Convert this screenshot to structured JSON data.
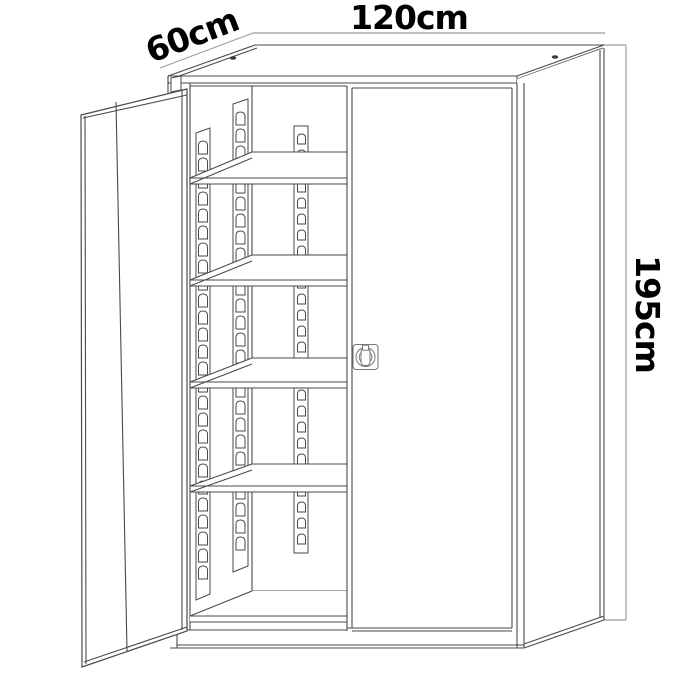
{
  "diagram": {
    "kind": "cabinet-dimension-drawing",
    "dimensions": {
      "width_label": "120cm",
      "depth_label": "60cm",
      "height_label": "195cm"
    }
  },
  "colors": {
    "background": "#ffffff",
    "outline": "#4a4a4a",
    "thin_line": "#6a6a6a",
    "dimension_line": "#9c9c9c",
    "label_text": "#000000",
    "lock_outline": "#787878",
    "screw_fill": "#3c3c3c"
  }
}
